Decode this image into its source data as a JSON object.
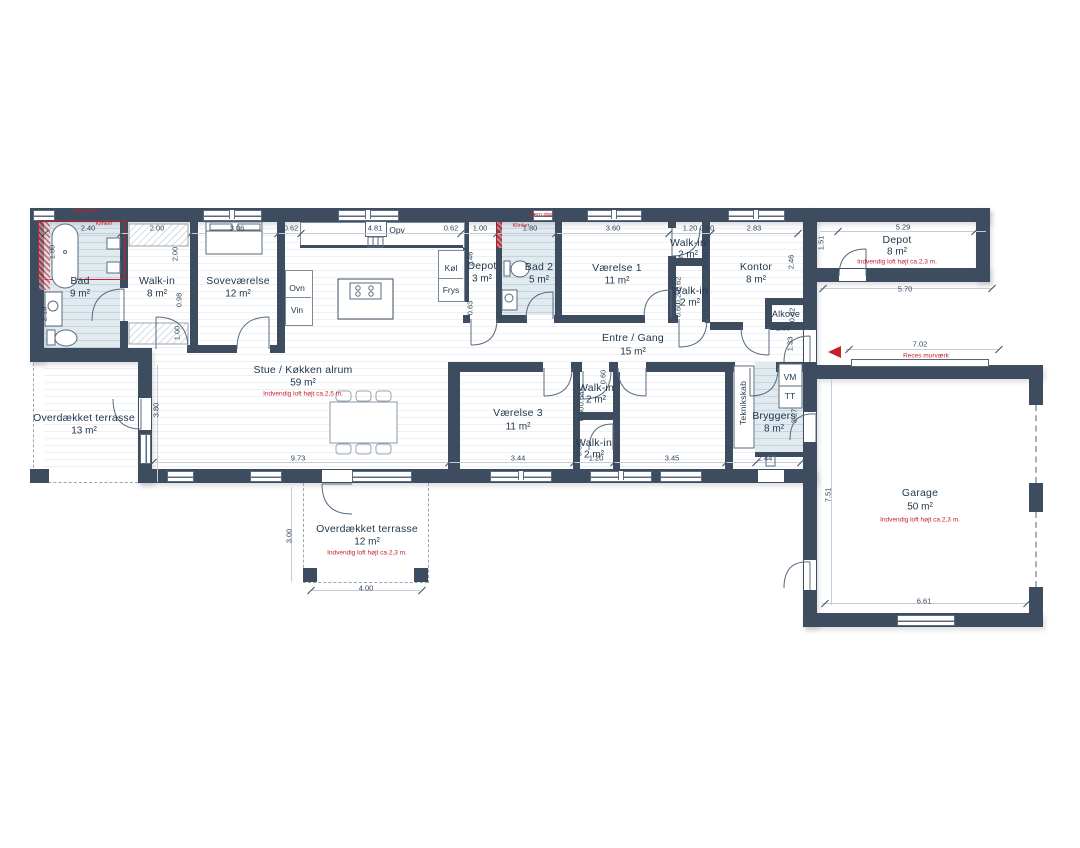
{
  "colors": {
    "wall": "#3d4c5f",
    "wet_floor": "#cfdee5",
    "accent_red": "#c5202c"
  },
  "rooms": {
    "bad": {
      "name": "Bad",
      "area": "9 m²"
    },
    "walkin1": {
      "name": "Walk-in",
      "area": "8 m²"
    },
    "sove": {
      "name": "Soveværelse",
      "area": "12 m²"
    },
    "stue": {
      "name": "Stue / Køkken alrum",
      "area": "59 m²",
      "note": "Indvendig loft højt ca.2,5 m."
    },
    "depot3": {
      "name": "Depot",
      "area": "3 m²"
    },
    "bad2": {
      "name": "Bad 2",
      "area": "5 m²"
    },
    "v1": {
      "name": "Værelse 1",
      "area": "11 m²"
    },
    "wi_top": {
      "name": "Walk-in",
      "area": "2 m²"
    },
    "wi_mid": {
      "name": "Walk-in",
      "area": "2 m²"
    },
    "kontor": {
      "name": "Kontor",
      "area": "8 m²"
    },
    "alkove": {
      "name": "Alkove"
    },
    "entre": {
      "name": "Entre / Gang",
      "area": "15 m²"
    },
    "depot8": {
      "name": "Depot",
      "area": "8 m²",
      "note": "Indvendig loft højt ca.2,3 m."
    },
    "v3": {
      "name": "Værelse 3",
      "area": "11 m²"
    },
    "wi_b1": {
      "name": "Walk-in",
      "area": "2 m²"
    },
    "wi_b2": {
      "name": "Walk-in",
      "area": "2 m²"
    },
    "teknik": {
      "name": "Teknikskab"
    },
    "bryggers": {
      "name": "Bryggers",
      "area": "8 m²"
    },
    "garage": {
      "name": "Garage",
      "area": "50 m²",
      "note": "Indvendig loft højt ca.2,3 m."
    },
    "terrasse1": {
      "name": "Overdækket terrasse",
      "area": "13 m²"
    },
    "terrasse2": {
      "name": "Overdækket terrasse",
      "area": "12 m²",
      "note": "Indvendig loft højt ca.2,3 m."
    }
  },
  "appliances": {
    "ovn": "Ovn",
    "vin": "Vin",
    "opv": "Opv",
    "koel": "Køl",
    "frys": "Frys",
    "vm": "VM",
    "tt": "TT"
  },
  "labels": {
    "reces": "Reces murværk",
    "vaern_glas_1": "Værn glas",
    "klinker_1": "Klinker",
    "vaern_glas_2": "Værn glas",
    "klinker_2": "Klinker"
  },
  "dims": {
    "top_bad": "2.40",
    "top_walkin": "2.00",
    "top_sove": "3.06",
    "top_gap1": "0.62",
    "top_kitchen": "4.81",
    "top_gap2": "0.62",
    "top_depot": "1.00",
    "top_bad2": "1.80",
    "top_v1": "3.60",
    "top_witop_w": "1.20",
    "top_witop_d": "0.60",
    "top_kontor": "2.83",
    "wing_w": "5.29",
    "wing_h": "1.51",
    "wing_b": "5.70",
    "reces_w": "7.02",
    "left_tub": "1.80",
    "left_low": "2.18",
    "col_walkin_a": "2.00",
    "col_walkin_b": "0.98",
    "col_walkin_c": "1.00",
    "mid_depot_h": "2.46",
    "mid_depot_b": "0.63",
    "kontor_h": "2.46",
    "alkove_w": "1.00",
    "alkove_d": "0.62",
    "alkove_h": "1.33",
    "witop_a": "0.60",
    "witop_b": "0.68",
    "wimid_a": "0.62",
    "wimid_b": "0.20",
    "wimid_c": "0.60",
    "bot_stue": "9.73",
    "stue_h": "3.80",
    "bot_v3": "3.44",
    "bot_wib": "1.20",
    "bot_v2": "3.45",
    "bot_bryg": "2.44",
    "terr2_h": "3.00",
    "terr2_w": "4.00",
    "wib_a": "0.60",
    "wib_b": "0.68",
    "wib_c": "0.30",
    "wib_d": "0.60",
    "bryg_h": "3.27",
    "garage_h": "7.51",
    "garage_w": "6.61"
  }
}
